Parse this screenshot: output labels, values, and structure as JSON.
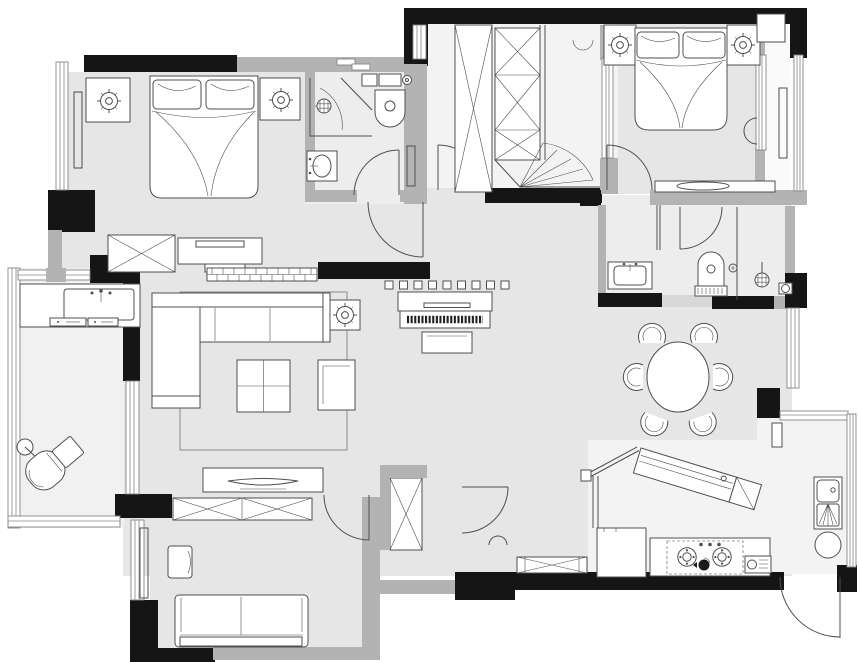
{
  "meta": {
    "type": "architectural-floor-plan",
    "description": "Black-and-white top-down apartment floor plan drawing with no text labels",
    "units_shown": "none",
    "labels_visible": "none"
  },
  "colors": {
    "bg": "#ffffff",
    "wall": "#151515",
    "wall_gray": "#b3b3b3",
    "wall_light": "#d8d8d8",
    "floor": "#e6e6e6",
    "floor_bath": "#ededed",
    "floor_light": "#f3f3f3",
    "line": "#4f4f4f",
    "furn": "#ffffff"
  },
  "rooms": [
    {
      "id": "bedroom-1",
      "area": "top-left",
      "furniture": [
        "double-bed",
        "pillow",
        "pillow",
        "nightstand",
        "nightstand",
        "ceiling-light",
        "ceiling-light",
        "radiator",
        "window",
        "wardrobe-x",
        "dresser-with-tray"
      ]
    },
    {
      "id": "bathroom-1",
      "area": "top-center-left",
      "furniture": [
        "corner-shower",
        "shower-head",
        "swing-door",
        "toilet-with-cistern",
        "vanity-sink",
        "radiator",
        "sliding-window"
      ]
    },
    {
      "id": "walk-in-closet",
      "area": "top-center",
      "furniture": [
        "tall-wardrobe-x",
        "stacked-wardrobe-x",
        "corner-hanging-fan",
        "door-swing",
        "window"
      ]
    },
    {
      "id": "master-bedroom",
      "area": "top-right",
      "furniture": [
        "double-bed",
        "pillow",
        "pillow",
        "nightstand",
        "nightstand",
        "ceiling-light",
        "ceiling-light",
        "wall-lamp",
        "low-shelf-with-tray",
        "door-swing",
        "sliding-window"
      ]
    },
    {
      "id": "master-bay-window",
      "area": "top-right-edge",
      "furniture": [
        "radiator",
        "cabinet",
        "window"
      ]
    },
    {
      "id": "ensuite-bathroom",
      "area": "right-middle",
      "furniture": [
        "vanity-sink",
        "toilet",
        "flush-button",
        "shower-head",
        "floor-drain",
        "glass-partition",
        "door-swing"
      ]
    },
    {
      "id": "living-room",
      "area": "center-left",
      "furniture": [
        "l-shaped-sofa",
        "coffee-table",
        "armchair",
        "side-table",
        "ceiling-light",
        "rug",
        "piano",
        "piano-bench",
        "dot-screen",
        "brick-half-wall",
        "tv-cabinet",
        "tv"
      ]
    },
    {
      "id": "balcony",
      "area": "left-edge",
      "furniture": [
        "laundry-counter",
        "laundry-sink",
        "drawer-unit",
        "drawer-unit",
        "lounge-chair",
        "side-table",
        "floor-lamp",
        "glass-wall",
        "sliding-door"
      ]
    },
    {
      "id": "junior-bedroom",
      "area": "bottom-left",
      "furniture": [
        "wardrobe-x",
        "desk-chair",
        "daybed-sofa",
        "radiator",
        "window",
        "door-swing"
      ]
    },
    {
      "id": "hallway",
      "area": "bottom-center",
      "furniture": [
        "closet-x",
        "shoe-cabinet-x",
        "door-swing",
        "door-stop"
      ]
    },
    {
      "id": "dining-room",
      "area": "center-right",
      "furniture": [
        "round-table",
        "fan-chair",
        "fan-chair",
        "fan-chair",
        "fan-chair",
        "fan-chair",
        "fan-chair",
        "window"
      ]
    },
    {
      "id": "kitchen",
      "area": "bottom-right",
      "furniture": [
        "angled-bar-counter",
        "bar-faucet",
        "guard-rail",
        "fridge",
        "counter",
        "gas-hob-2-burner",
        "control-knobs",
        "kettle",
        "small-appliance",
        "double-sink",
        "round-stool",
        "wall-cabinet",
        "entry-door-swing",
        "window"
      ]
    }
  ],
  "icons": [
    "ceiling-light-icon",
    "shower-head-icon",
    "burner-icon",
    "radiator-icon",
    "door-arc-icon",
    "window-icon",
    "x-cabinet-icon"
  ]
}
